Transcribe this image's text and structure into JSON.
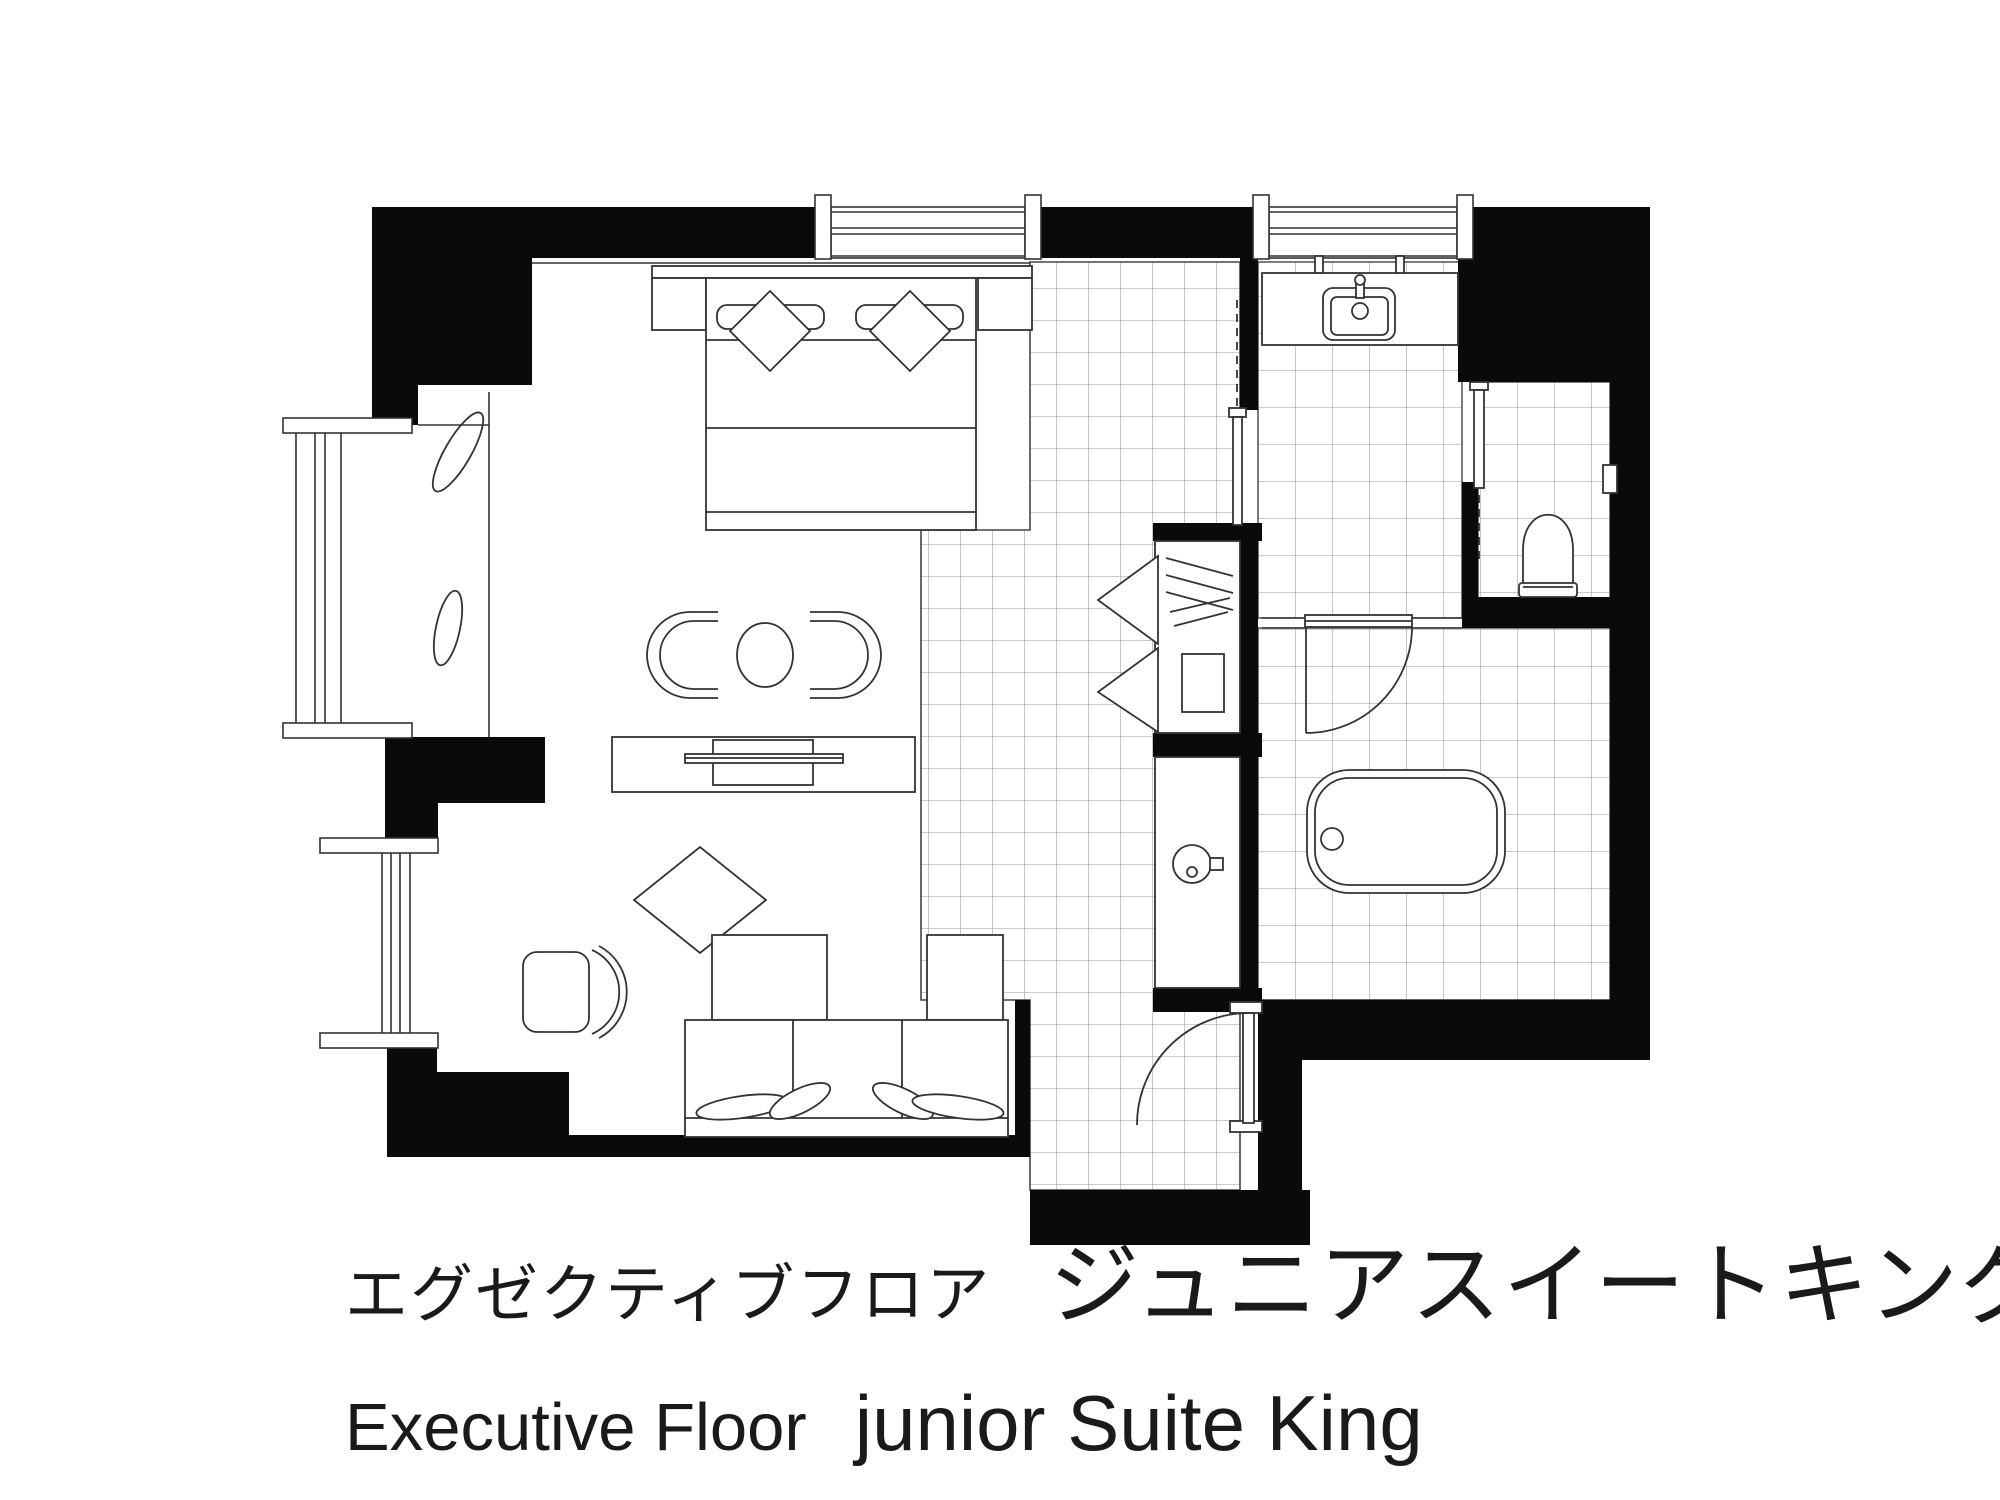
{
  "captions": {
    "jp": {
      "floor": "エグゼクティブフロア",
      "room": "ジュニアスイートキング"
    },
    "en": {
      "floor": "Executive Floor",
      "room": "junior Suite King"
    }
  },
  "colors": {
    "wall": "#0a0a0a",
    "line": "#333333",
    "tile_line": "#999999",
    "background": "#ffffff",
    "text": "#1a1a1a"
  },
  "floor_plan": {
    "type": "hotel-guest-room",
    "rooms": [
      {
        "name": "bedroom-living",
        "floor": "carpet"
      },
      {
        "name": "entry-corridor",
        "floor": "tile"
      },
      {
        "name": "washroom-vanity",
        "floor": "tile"
      },
      {
        "name": "toilet-room",
        "floor": "tile"
      },
      {
        "name": "bathroom",
        "floor": "tile"
      },
      {
        "name": "wardrobe-closet",
        "floor": "tile"
      },
      {
        "name": "minibar-counter",
        "floor": "tile"
      }
    ],
    "fixtures": [
      "king-bed",
      "bed-pillows-x2",
      "bed-bolsters-x2",
      "nightstands-x2",
      "lounge-chairs-x2",
      "round-side-table",
      "tv-board",
      "television",
      "ottoman",
      "coffee-table",
      "corner-sofa",
      "sofa-cushions-x4",
      "desk-chair",
      "plants-x2",
      "clothes-hangers",
      "closet-shelf",
      "kettle",
      "washbasin",
      "faucet",
      "bathtub",
      "toilet",
      "toilet-paper-holder",
      "shower-door",
      "entrance-door",
      "pocket-sliding-doors-x2",
      "windows-x4"
    ]
  }
}
